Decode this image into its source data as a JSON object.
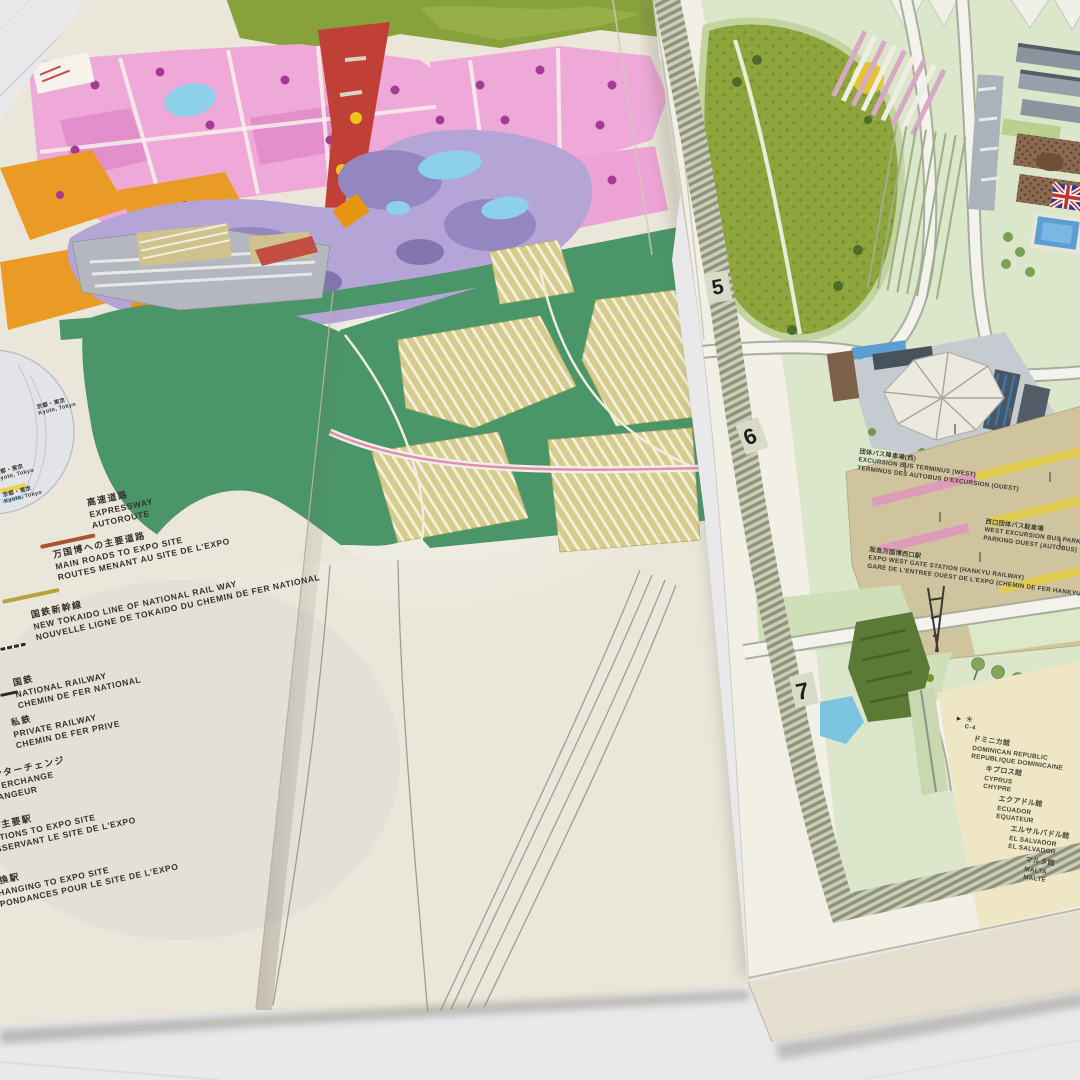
{
  "photo": {
    "subject": "Two folded Expo '70 Osaka site guide maps photographed on a light tiled floor"
  },
  "colors": {
    "floor": "#e9e9ec",
    "paper_cream": "#eae6d9",
    "jade_green": "#4a9668",
    "olive_green": "#87a13b",
    "pavilion_pink": "#efa9d9",
    "pavilion_orange": "#e99b25",
    "symbol_zone_red": "#c04038",
    "park_purple": "#b4a5d6",
    "pond_cyan": "#8cd0ea",
    "parking_khaki": "#d6cc8c",
    "right_map_base": "#dce6ca",
    "bus_park_tan": "#cfc49d",
    "stripe_pink": "#dc9cba",
    "stripe_yellow": "#e1cc52",
    "panel_cream": "#efe6c6"
  },
  "left_map": {
    "legend": {
      "items": [
        {
          "ja": "高速道路",
          "en": "EXPRESSWAY",
          "fr": "AUTOROUTE",
          "symbol": "expressway-line",
          "symbol_color": "#a8542f"
        },
        {
          "ja": "万国博への主要道路",
          "en": "MAIN ROADS TO EXPO SITE",
          "fr": "ROUTES MENANT AU SITE DE L'EXPO",
          "symbol": "main-road-line",
          "symbol_color": "#b8a23c"
        },
        {
          "ja": "国鉄新幹線",
          "en": "NEW TOKAIDO LINE OF NATIONAL RAIL WAY",
          "fr": "NOUVELLE LIGNE DE TOKAIDO DU CHEMIN DE FER NATIONAL",
          "symbol": "shinkansen-line",
          "symbol_color": "#2a2a2a"
        },
        {
          "ja": "国鉄",
          "en": "NATIONAL RAILWAY",
          "fr": "CHEMIN DE FER NATIONAL",
          "symbol": "national-railway-line",
          "symbol_color": "#2a2a2a"
        },
        {
          "ja": "私鉄",
          "en": "PRIVATE RAILWAY",
          "fr": "CHEMIN DE FER PRIVE",
          "symbol": "private-railway-line",
          "symbol_color": "#2a2a2a"
        },
        {
          "ja": "ンターチェンジ",
          "en": "TERCHANGE",
          "fr": "ANGEUR",
          "symbol": "interchange-mark",
          "symbol_color": "#2a2a2a"
        },
        {
          "ja": "の主要駅",
          "en": "ATIONS TO EXPO SITE",
          "fr": "SSERVANT LE SITE DE L'EXPO",
          "symbol": "station-mark",
          "symbol_color": "#2a2a2a"
        },
        {
          "ja": "乗換駅",
          "en": "CHANGING TO EXPO SITE",
          "fr": "SPONDANCES POUR LE SITE DE L'EXPO",
          "symbol": "transfer-station-mark",
          "symbol_color": "#2a2a2a"
        }
      ]
    },
    "inset_labels": [
      {
        "ja": "京都・東京",
        "en": "Kyoto, Tokyo"
      },
      {
        "ja": "京都・東京",
        "en": "Kyoto, Tokyo"
      },
      {
        "ja": "京都・東京",
        "en": "Kyoto, Tokyo"
      }
    ]
  },
  "right_map": {
    "grid_numbers": [
      "5",
      "6",
      "7"
    ],
    "labels": {
      "bus_terminus": {
        "ja": "団体バス降車場(西)",
        "en": "EXCURSION BUS TERMINUS (WEST)",
        "fr": "TERMINUS DES AUTOBUS D'EXCURSION (OUEST)"
      },
      "bus_park": {
        "ja": "西口団体バス駐車場",
        "en": "WEST EXCURSION BUS PARK",
        "fr": "PARKING OUEST (AUTOBUS)"
      },
      "west_gate_station": {
        "ja": "阪急万国博西口駅",
        "en": "EXPO WEST GATE STATION (HANKYU RAILWAY)",
        "fr": "GARE DE L'ENTREE OUEST DE L'EXPO (CHEMIN DE FER HANKYU)"
      }
    },
    "pavilion_list": {
      "marker": "C-4",
      "items": [
        {
          "ja": "ドミニカ館",
          "en": "DOMINICAN REPUBLIC",
          "fr": "REPUBLIQUE DOMINICAINE"
        },
        {
          "ja": "キプロス館",
          "en": "CYPRUS",
          "fr": "CHYPRE"
        },
        {
          "ja": "エクアドル館",
          "en": "ECUADOR",
          "fr": "EQUATEUR"
        },
        {
          "ja": "エルサルバドル館",
          "en": "EL SALVADOR",
          "fr": "EL SALVADOR"
        },
        {
          "ja": "マルタ館",
          "en": "MALTA",
          "fr": "MALTE"
        }
      ]
    }
  }
}
